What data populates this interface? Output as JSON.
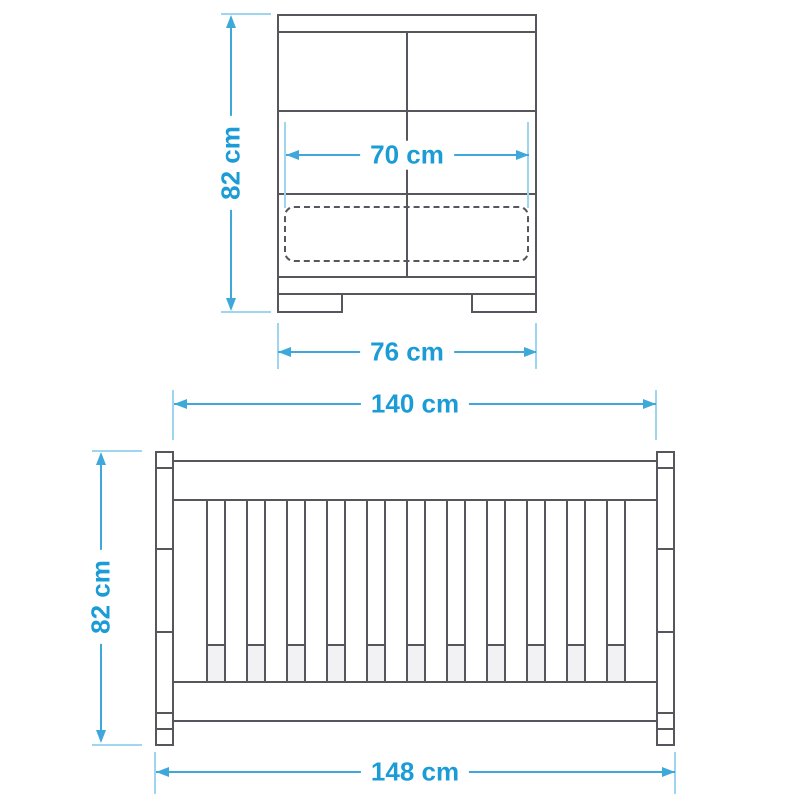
{
  "diagram": {
    "product": "Cot bed dimension drawing",
    "views": {
      "end_view": {
        "name": "end view",
        "parts": [
          "top rail",
          "headboard panel",
          "mattress (dashed outline)",
          "base",
          "feet"
        ],
        "dimensions": {
          "height": "82 cm",
          "inner_width": "70 cm",
          "outer_width": "76 cm"
        }
      },
      "side_view": {
        "name": "side view",
        "parts": [
          "corner posts",
          "top rail",
          "slats",
          "mattress (seen between slats)",
          "bottom rail"
        ],
        "slat_gap_count": 11,
        "dimensions": {
          "inner_length": "140 cm",
          "height": "82 cm",
          "outer_length": "148 cm"
        }
      }
    },
    "colors": {
      "furniture_line": "#56565c",
      "dimension_text": "#1b9cd6",
      "dimension_line": "#3fa8da",
      "extension_line": "#9fd6ef",
      "mattress_fill": "#f2f2f4",
      "background": "#ffffff"
    }
  }
}
